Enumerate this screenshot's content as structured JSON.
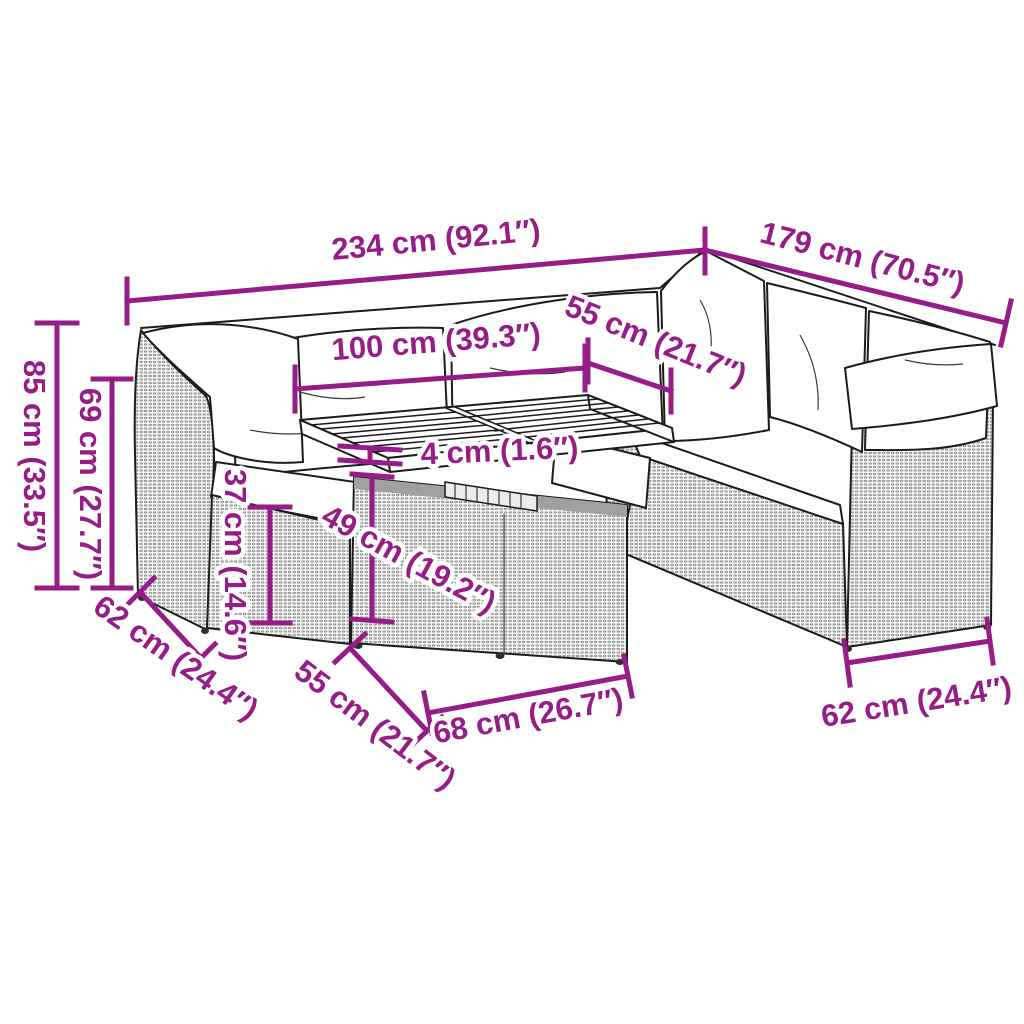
{
  "diagram": {
    "accent_color": "#961c87",
    "line_color": "#1c1c1c",
    "background_color": "#ffffff",
    "subject": "garden-sofa-set-dimension-diagram",
    "dimensions": {
      "overall_width": "234 cm (92.1″)",
      "right_length": "179 cm (70.5″)",
      "table_width": "100 cm (39.3″)",
      "table_depth": "55 cm (21.7″)",
      "top_thickness": "4 cm (1.6″)",
      "table_height": "49 cm (19.2″)",
      "overall_height": "85 cm (33.5″)",
      "backrest_height": "69 cm (27.7″)",
      "seat_height": "37 cm (14.6″)",
      "left_depth": "62 cm (24.4″)",
      "base_depth": "55 cm (21.7″)",
      "base_width": "68 cm (26.7″)",
      "right_depth": "62 cm (24.4″)"
    }
  }
}
